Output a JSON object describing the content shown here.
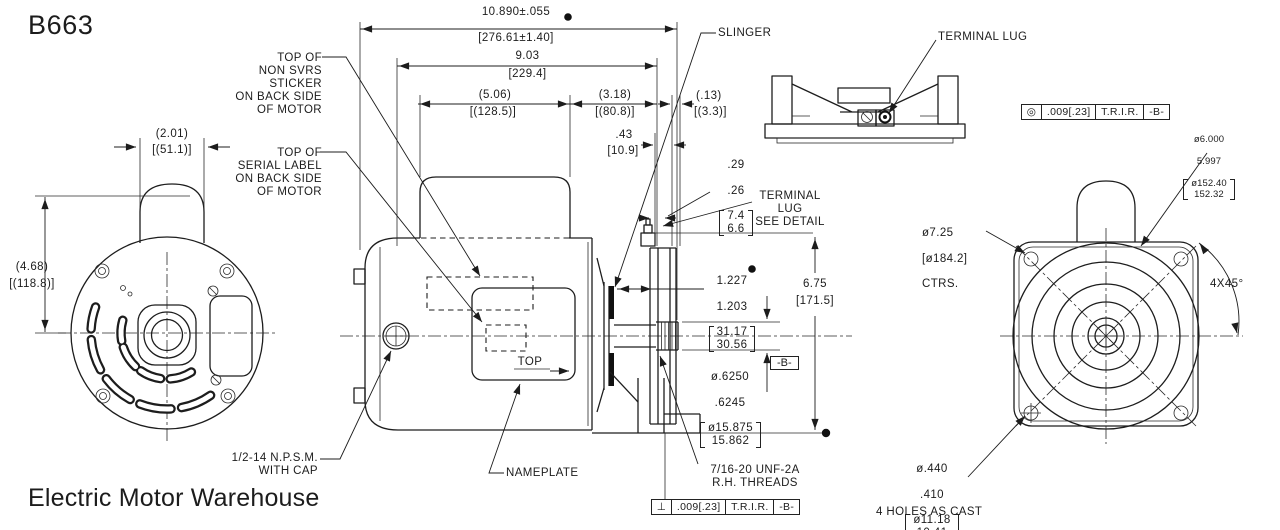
{
  "drawing": {
    "part_number": "B663",
    "vendor": "Electric Motor Warehouse"
  },
  "labels": {
    "non_svrs": "TOP OF\nNON SVRS\nSTICKER\nON BACK SIDE\nOF MOTOR",
    "serial": "TOP OF\nSERIAL LABEL\nON BACK SIDE\nOF MOTOR",
    "npsm": "1/2-14 N.P.S.M.\nWITH CAP",
    "nameplate": "NAMEPLATE",
    "slinger": "SLINGER",
    "terminal_lug": "TERMINAL LUG",
    "terminal_lug_ref": "TERMINAL\nLUG\nSEE DETAIL",
    "threads": "7/16-20 UNF-2A\nR.H. THREADS",
    "holes": "4 HOLES AS CAST",
    "chamfer": "4X45°",
    "top_marker": "TOP"
  },
  "dims": {
    "overall": {
      "inch": "10.890±.055",
      "mm": "[276.61±1.40]"
    },
    "c_face": {
      "inch": "9.03",
      "mm": "[229.4]"
    },
    "sticker_len": {
      "inch": "(5.06)",
      "mm": "[(128.5)]"
    },
    "rear": {
      "inch": "(3.18)",
      "mm": "[(80.8)]"
    },
    "gap": {
      "inch": "(.13)",
      "mm": "[(3.3)]"
    },
    "boss": {
      "inch": ".43",
      "mm": "[10.9]"
    },
    "lug_h": {
      "inch_max": ".29",
      "inch_min": ".26",
      "mm_max": "7.4",
      "mm_min": "6.6"
    },
    "shaft_ext": {
      "inch_max": "1.227",
      "inch_min": "1.203",
      "mm_max": "31.17",
      "mm_min": "30.56"
    },
    "base_h": {
      "inch": "6.75",
      "mm": "[171.5]"
    },
    "shaft_dia": {
      "inch_max": "ø.6250",
      "inch_min": ".6245",
      "mm_max": "ø15.875",
      "mm_min": "15.862"
    },
    "dome_w": {
      "inch": "(2.01)",
      "mm": "[(51.1)]"
    },
    "height": {
      "inch": "(4.68)",
      "mm": "[(118.8)]"
    },
    "spigot": {
      "inch_max": "ø6.000",
      "inch_min": "5.997",
      "mm_max": "ø152.40",
      "mm_min": "152.32"
    },
    "bolt_circle": {
      "l1": "ø7.25",
      "l2": "[ø184.2]",
      "l3": "CTRS."
    },
    "hole_dia": {
      "inch_max": "ø.440",
      "inch_min": ".410",
      "mm_max": "ø11.18",
      "mm_min": "10.41"
    }
  },
  "fcf": {
    "runout_face": {
      "sym": "◎",
      "tol": ".009[.23]",
      "mod": "T.R.I.R.",
      "datum": "-B-"
    },
    "runout_perp": {
      "sym": "⊥",
      "tol": ".009[.23]",
      "mod": "T.R.I.R.",
      "datum": "-B-"
    },
    "datum_b": "-B-"
  }
}
